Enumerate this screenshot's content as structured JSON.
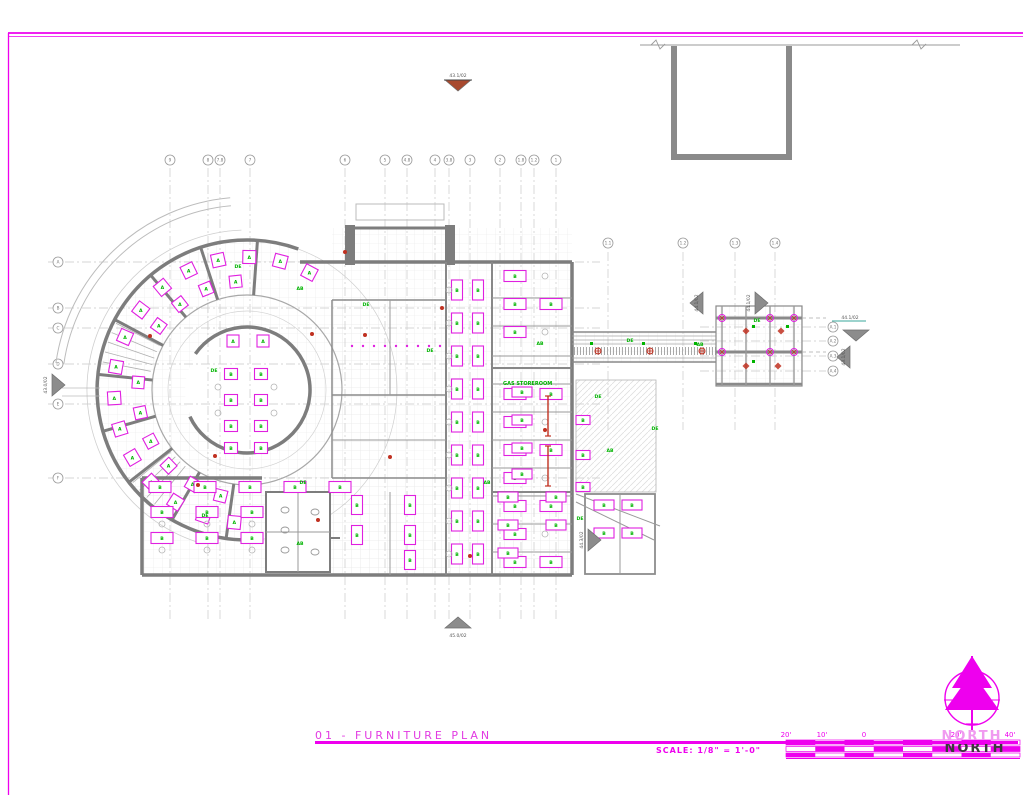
{
  "drawing": {
    "number_title": "01 - FURNITURE PLAN",
    "scale_prefix": "SCALE:",
    "scale_value": "1/8\" = 1'-0\"",
    "north": {
      "outline_label": "NORTH",
      "solid_label": "NORTH"
    }
  },
  "colors": {
    "magenta": "#ee00ee",
    "furniture": "#e020e0",
    "wall": "#7d7d7d",
    "green": "#00b400",
    "red": "#c03020",
    "brown": "#a8492e",
    "gridline": "#c9c9c9",
    "teal": "#3aa79b"
  },
  "scale_bar": {
    "x_start": 786,
    "x_end": 1020,
    "ticks": [
      {
        "label": "20'",
        "x": 786
      },
      {
        "label": "10'",
        "x": 822
      },
      {
        "label": "0",
        "x": 864
      },
      {
        "label": "20'",
        "x": 956
      },
      {
        "label": "40'",
        "x": 1010
      }
    ]
  },
  "grid_bubbles": {
    "top": [
      {
        "label": "9",
        "x": 170
      },
      {
        "label": "8",
        "x": 208
      },
      {
        "label": "7.8",
        "x": 220
      },
      {
        "label": "7",
        "x": 250
      },
      {
        "label": "6",
        "x": 345
      },
      {
        "label": "5",
        "x": 385
      },
      {
        "label": "4.8",
        "x": 407
      },
      {
        "label": "4",
        "x": 435
      },
      {
        "label": "3.8",
        "x": 449
      },
      {
        "label": "3",
        "x": 470
      },
      {
        "label": "2",
        "x": 500
      },
      {
        "label": "1.8",
        "x": 521
      },
      {
        "label": "1.2",
        "x": 534
      },
      {
        "label": "1",
        "x": 556
      }
    ],
    "left": [
      {
        "label": "A",
        "y": 262
      },
      {
        "label": "B",
        "y": 308
      },
      {
        "label": "C",
        "y": 328
      },
      {
        "label": "D",
        "y": 364
      },
      {
        "label": "E",
        "y": 404
      },
      {
        "label": "F",
        "y": 478
      }
    ],
    "satellite_top": [
      {
        "label": "1.1",
        "x": 608
      },
      {
        "label": "1.2",
        "x": 683
      },
      {
        "label": "1.3",
        "x": 735
      },
      {
        "label": "1.4",
        "x": 775
      }
    ],
    "satellite_right": [
      {
        "label": "A.1",
        "y": 327
      },
      {
        "label": "A.2",
        "y": 341
      },
      {
        "label": "A.3",
        "y": 356
      },
      {
        "label": "A.4",
        "y": 371
      }
    ]
  },
  "section_markers": [
    {
      "label": "43.1/02",
      "x": 458,
      "y": 80,
      "dir": "down",
      "fill": "#a8492e",
      "label_pos": "above"
    },
    {
      "label": "43.0/02",
      "x": 52,
      "y": 385,
      "dir": "right",
      "fill": "#8c8c8c",
      "label_pos": "left-rot"
    },
    {
      "label": "44.1/02",
      "x": 703,
      "y": 303,
      "dir": "left",
      "fill": "#8c8c8c",
      "label_pos": "left-rot"
    },
    {
      "label": "44.1/02",
      "x": 755,
      "y": 303,
      "dir": "right",
      "fill": "#8c8c8c",
      "label_pos": "left-rot"
    },
    {
      "label": "44.1/02",
      "x": 856,
      "y": 330,
      "dir": "down",
      "fill": "#8c8c8c",
      "label_pos": "above-teal"
    },
    {
      "label": "43.1/02",
      "x": 850,
      "y": 357,
      "dir": "left",
      "fill": "#8c8c8c",
      "label_pos": "left-rot"
    },
    {
      "label": "44.3/02",
      "x": 588,
      "y": 540,
      "dir": "right",
      "fill": "#8c8c8c",
      "label_pos": "left-rot"
    },
    {
      "label": "45.0/02",
      "x": 458,
      "y": 628,
      "dir": "up",
      "fill": "#8c8c8c",
      "label_pos": "below"
    }
  ],
  "room_labels": [
    {
      "text": "GAS STOREROOM",
      "x": 503,
      "y": 385
    }
  ],
  "furniture_letters": {
    "radial": "A",
    "desk": "B"
  },
  "green_tags": [
    {
      "t": "DE",
      "x": 238,
      "y": 268
    },
    {
      "t": "AB",
      "x": 300,
      "y": 290
    },
    {
      "t": "DE",
      "x": 366,
      "y": 306
    },
    {
      "t": "DE",
      "x": 430,
      "y": 352
    },
    {
      "t": "DE",
      "x": 598,
      "y": 398
    },
    {
      "t": "AB",
      "x": 610,
      "y": 452
    },
    {
      "t": "DE",
      "x": 655,
      "y": 430
    },
    {
      "t": "DE",
      "x": 303,
      "y": 484
    },
    {
      "t": "AB",
      "x": 487,
      "y": 484
    },
    {
      "t": "DE",
      "x": 205,
      "y": 517
    },
    {
      "t": "AB",
      "x": 300,
      "y": 545
    },
    {
      "t": "DE",
      "x": 580,
      "y": 520
    },
    {
      "t": "AB",
      "x": 540,
      "y": 345
    },
    {
      "t": "DE",
      "x": 630,
      "y": 342
    },
    {
      "t": "DE",
      "x": 757,
      "y": 322
    },
    {
      "t": "AB",
      "x": 700,
      "y": 346
    },
    {
      "t": "DE",
      "x": 214,
      "y": 372
    }
  ]
}
